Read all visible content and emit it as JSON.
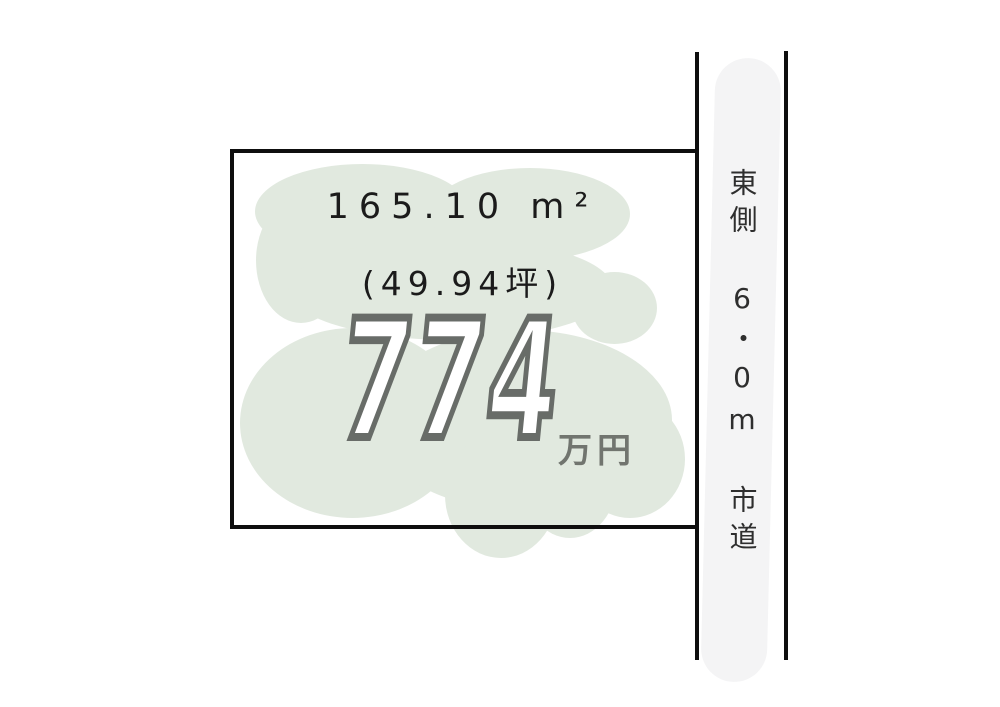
{
  "plot": {
    "area_m2": "165.10 m²",
    "area_tsubo": "(49.94坪)",
    "price_value": "774",
    "price_unit": "万円"
  },
  "road": {
    "side_label": "東側",
    "width_label": "6・0m",
    "type_label": "市道"
  },
  "colors": {
    "vegetation_fill": "#e1e9df",
    "road_surface_fill": "#f4f4f5",
    "boundary_line": "#0e0e0e",
    "price_outline_gray": "#686c68",
    "text_black": "#1b1b1b"
  }
}
